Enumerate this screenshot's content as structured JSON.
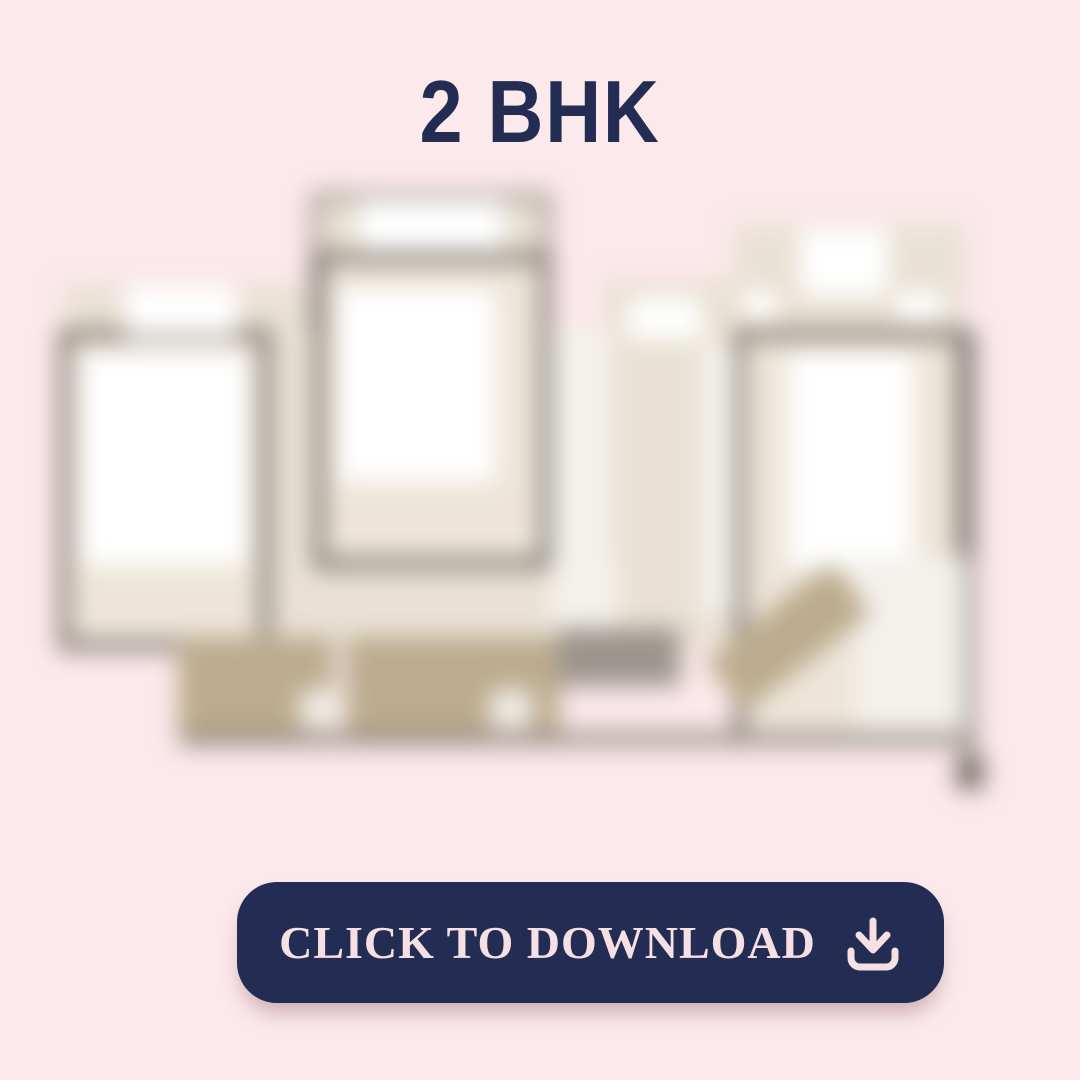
{
  "header": {
    "title": "2 BHK"
  },
  "floorplan": {
    "description": "blurred 2 BHK floor plan image"
  },
  "download": {
    "label": "CLICK TO DOWNLOAD",
    "icon": "download-icon"
  },
  "colors": {
    "background": "#fce9eb",
    "navy": "#232c52",
    "button_text": "#f6e0e3",
    "beige": "#e8e1d4",
    "beige_deep": "#ece5d8",
    "tan": "#bcab8e",
    "wall": "#5d5751",
    "gray": "#8a837c",
    "gray_mid": "#9b958e",
    "gray_dark": "#6e6862",
    "white": "#ffffff",
    "off_white": "#f4f1ec",
    "soft_white": "#f1ede6"
  }
}
